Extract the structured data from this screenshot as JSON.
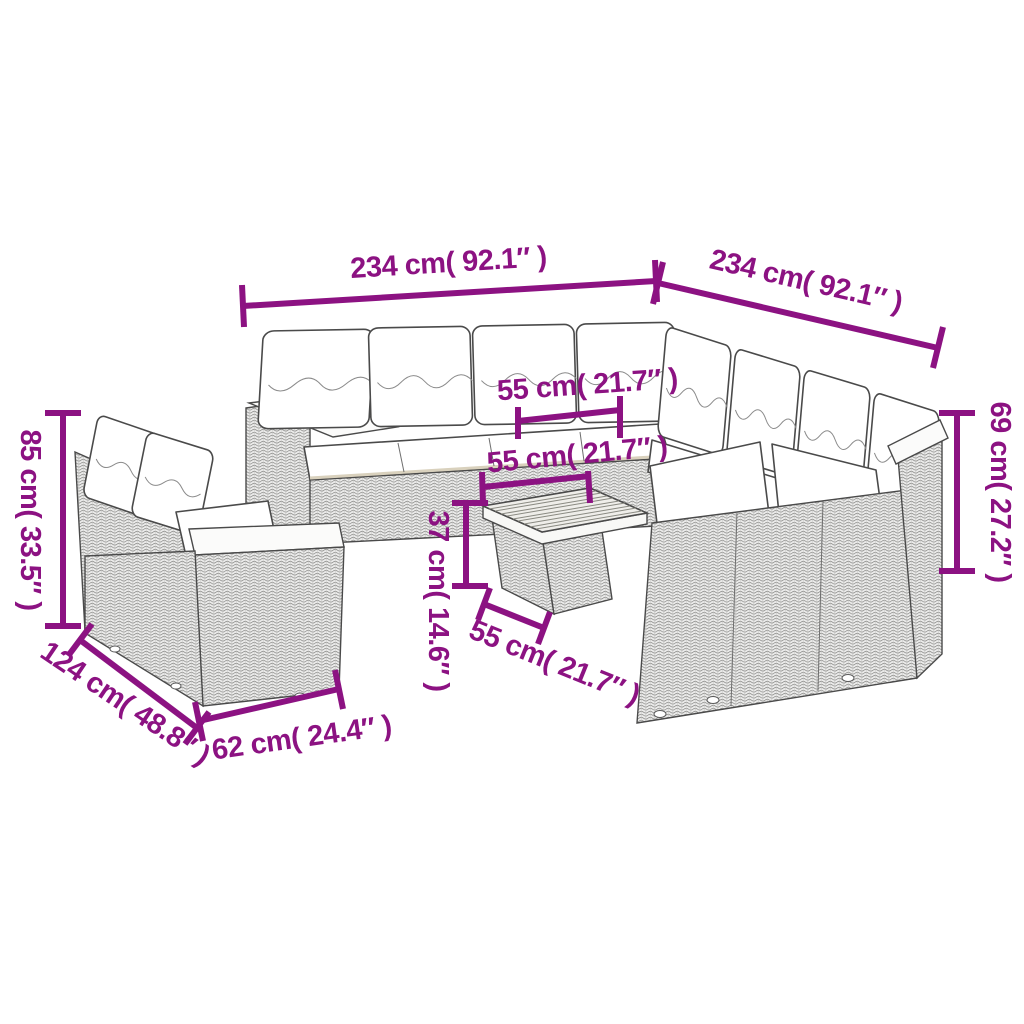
{
  "image_type": "product dimension diagram",
  "product_description": "modular rattan garden lounge set with white cushions, two-seater sofa and square wood-top coffee table",
  "style": {
    "annotation_color": "#8C1282",
    "furniture_line_color": "#4a4a4a",
    "background_color": "#ffffff",
    "cushion_color": "#ffffff"
  },
  "dimensions": {
    "sofa_left_length": "234 cm( 92.1″ )",
    "sofa_right_length": "234 cm( 92.1″ )",
    "backrest_height_left": "85 cm( 33.5″ )",
    "backrest_height_right": "69 cm( 27.2″ )",
    "seat_depth": "55 cm( 21.7″ )",
    "table_width": "55 cm( 21.7″ )",
    "table_depth": "55 cm( 21.7″ )",
    "table_height": "37 cm( 14.6″ )",
    "small_sofa_width": "124 cm( 48.8″ )",
    "small_sofa_depth": "62 cm( 24.4″ )"
  }
}
